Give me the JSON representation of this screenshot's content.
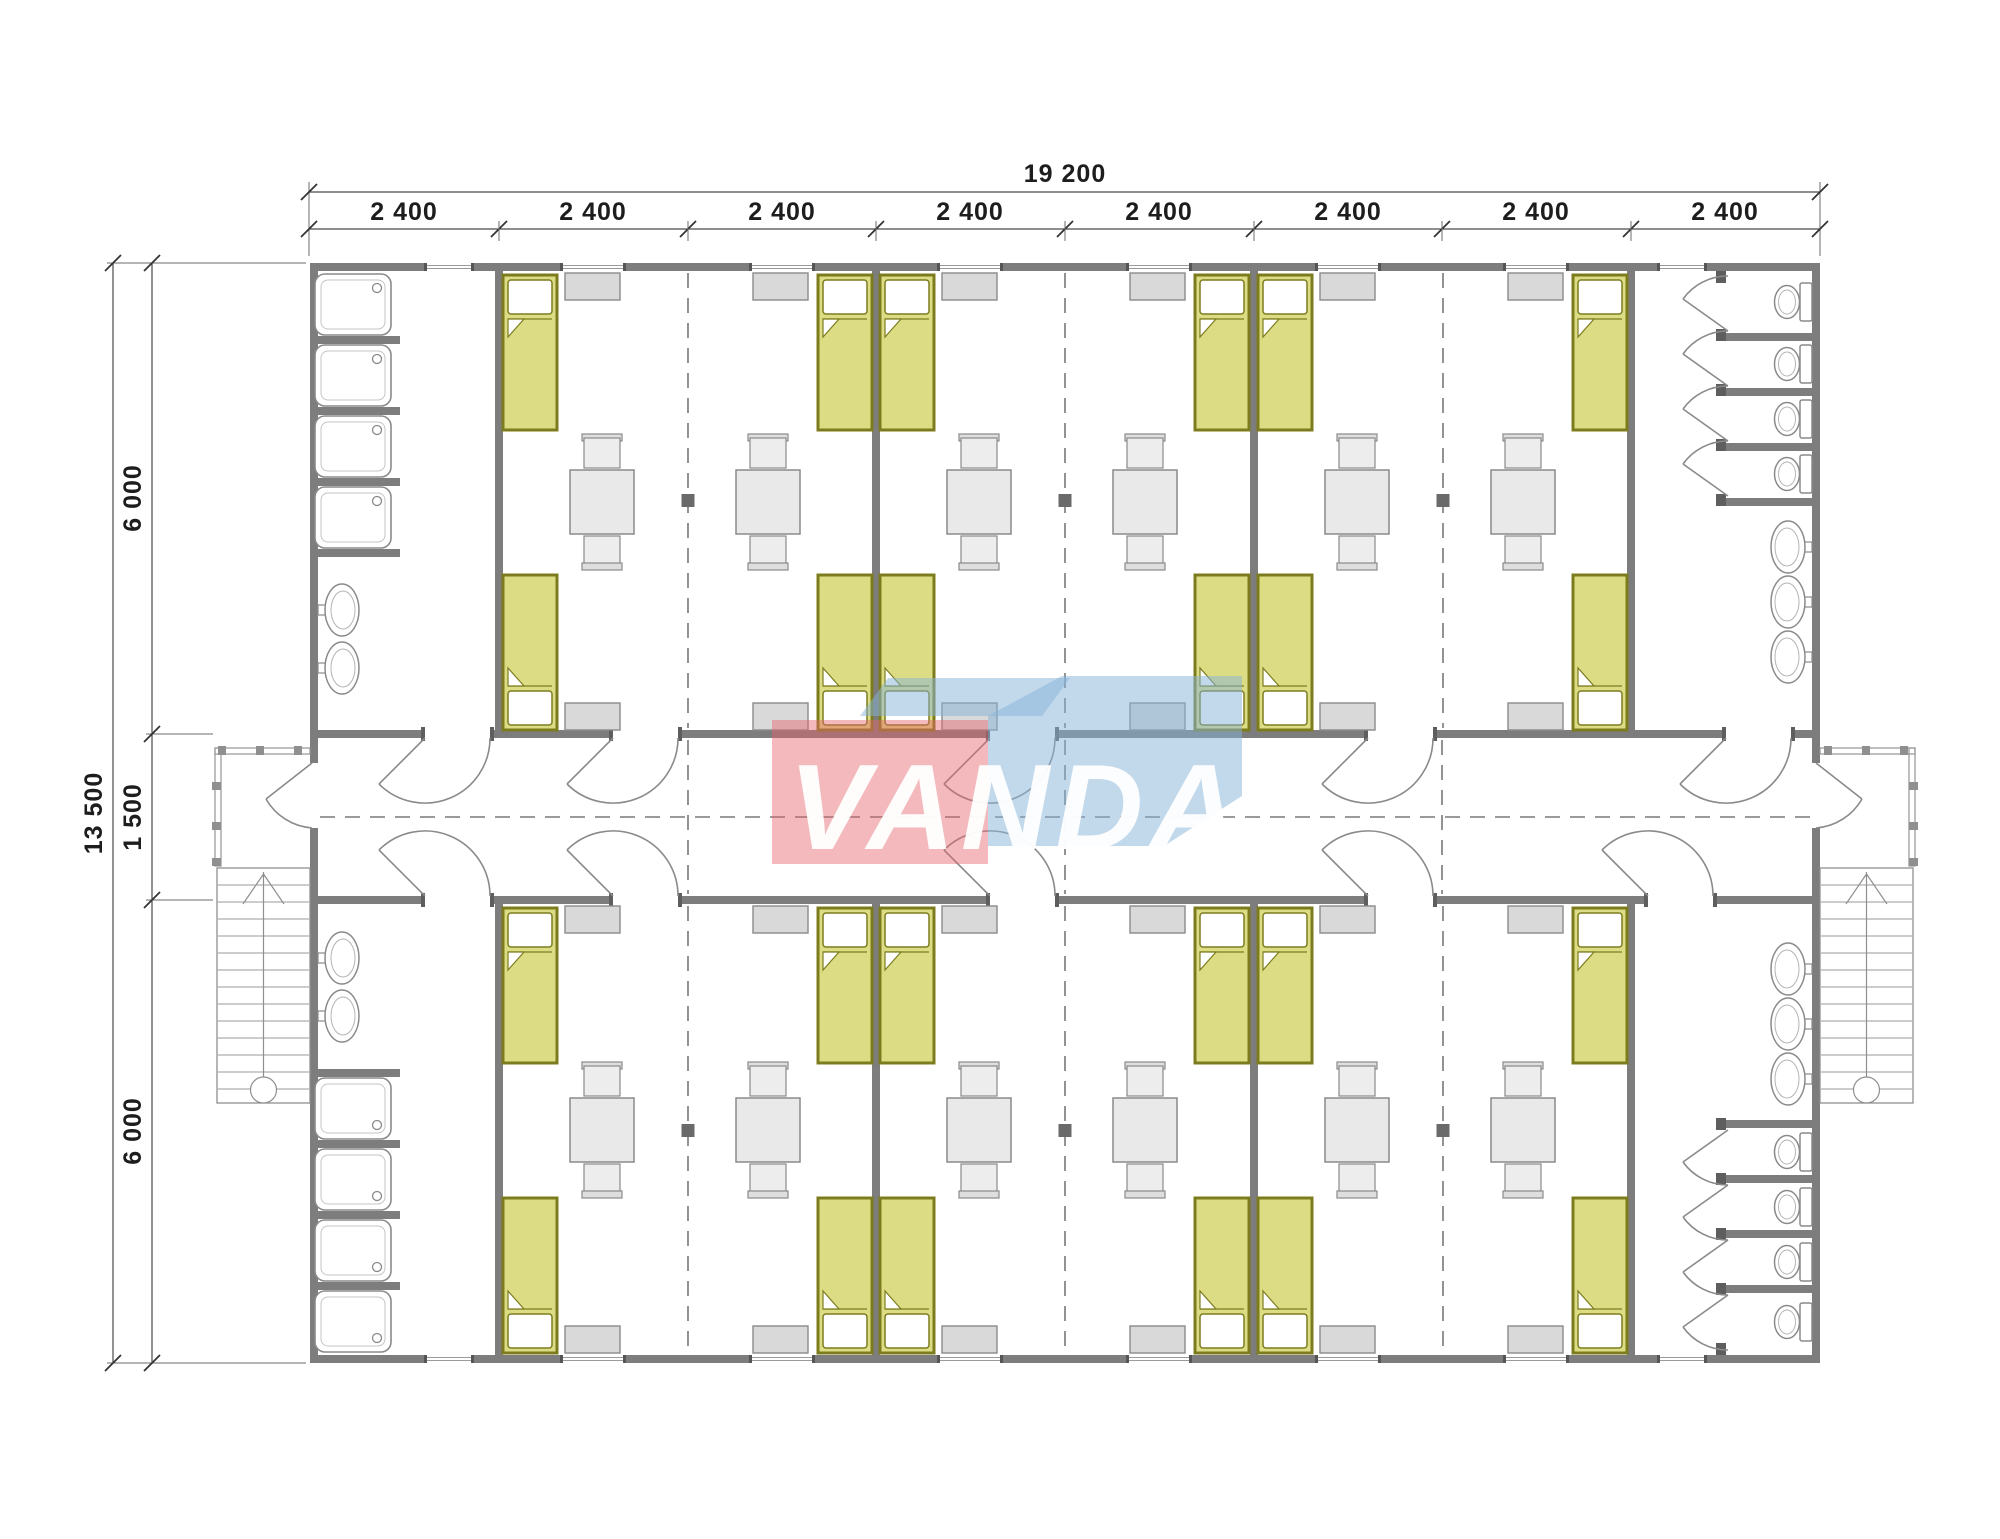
{
  "drawing": {
    "watermark_text": "VANDA"
  },
  "dimensions": {
    "overall_width": "19 200",
    "module_widths": [
      "2 400",
      "2 400",
      "2 400",
      "2 400",
      "2 400",
      "2 400",
      "2 400",
      "2 400"
    ],
    "overall_height": "13 500",
    "height_segments": [
      "6 000",
      "1 500",
      "6 000"
    ]
  },
  "fixtures": {
    "bed_icon": 24,
    "table_with_chairs_icon": 12,
    "wardrobe_icon": 24,
    "shower_icon": 8,
    "toilet_icon": 8,
    "washbasin_icon": 10,
    "staircase_icon": 2
  },
  "colors": {
    "wall": "#7d7d7d",
    "bed_fill": "#dcdc84",
    "bed_border": "#7c7c1e",
    "furniture_fill": "#e9e9e9",
    "watermark_red": "#e5646a",
    "watermark_blue": "#85b3d9"
  }
}
